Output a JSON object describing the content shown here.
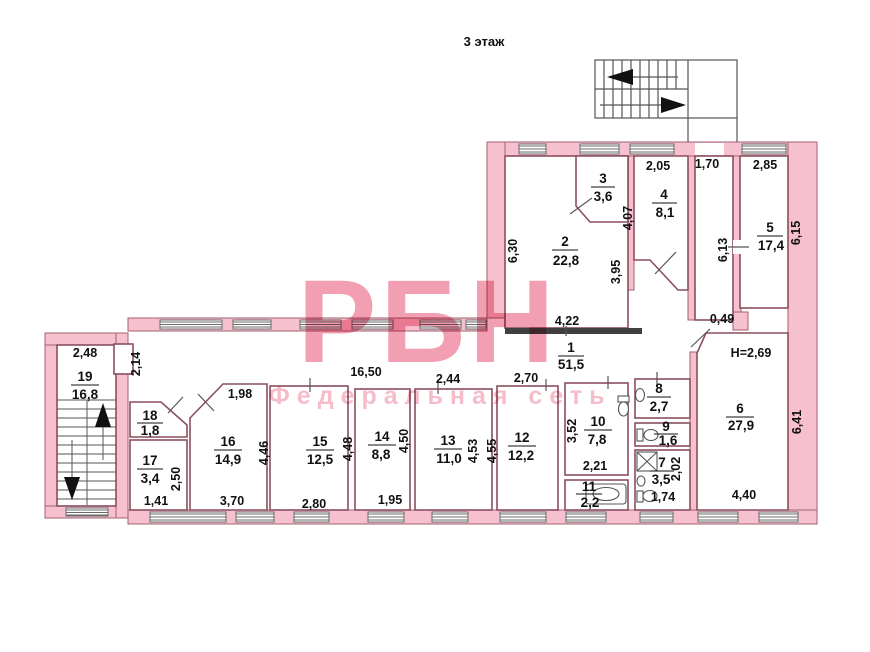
{
  "title": "3 этаж",
  "watermark": {
    "brand": "РБН",
    "subtitle": "Федеральная сеть"
  },
  "height_note": "H=2,69",
  "rooms": [
    {
      "num": "1",
      "area": "51,5"
    },
    {
      "num": "2",
      "area": "22,8"
    },
    {
      "num": "3",
      "area": "3,6"
    },
    {
      "num": "4",
      "area": "8,1"
    },
    {
      "num": "5",
      "area": "17,4"
    },
    {
      "num": "6",
      "area": "27,9"
    },
    {
      "num": "7",
      "area": "3,5"
    },
    {
      "num": "8",
      "area": "2,7"
    },
    {
      "num": "9",
      "area": "1,6"
    },
    {
      "num": "10",
      "area": "7,8"
    },
    {
      "num": "11",
      "area": "2,2"
    },
    {
      "num": "12",
      "area": "12,2"
    },
    {
      "num": "13",
      "area": "11,0"
    },
    {
      "num": "14",
      "area": "8,8"
    },
    {
      "num": "15",
      "area": "12,5"
    },
    {
      "num": "16",
      "area": "14,9"
    },
    {
      "num": "17",
      "area": "3,4"
    },
    {
      "num": "18",
      "area": "1,8"
    },
    {
      "num": "19",
      "area": "16,8"
    }
  ],
  "dims": {
    "d630": "6,30",
    "d205": "2,05",
    "d407": "4,07",
    "d395": "3,95",
    "d170": "1,70",
    "d285": "2,85",
    "d613": "6,13",
    "d615": "6,15",
    "d049": "0,49",
    "d422": "4,22",
    "d1650": "16,50",
    "d214": "2,14",
    "d248": "2,48",
    "d198": "1,98",
    "d244": "2,44",
    "d270": "2,70",
    "d352": "3,52",
    "d446": "4,46",
    "d448": "4,48",
    "d450": "4,50",
    "d453": "4,53",
    "d455": "4,55",
    "d221": "2,21",
    "d250": "2,50",
    "d141": "1,41",
    "d370": "3,70",
    "d280": "2,80",
    "d195": "1,95",
    "d174": "1,74",
    "d202": "2,02",
    "d641": "6,41",
    "d440": "4,40"
  }
}
